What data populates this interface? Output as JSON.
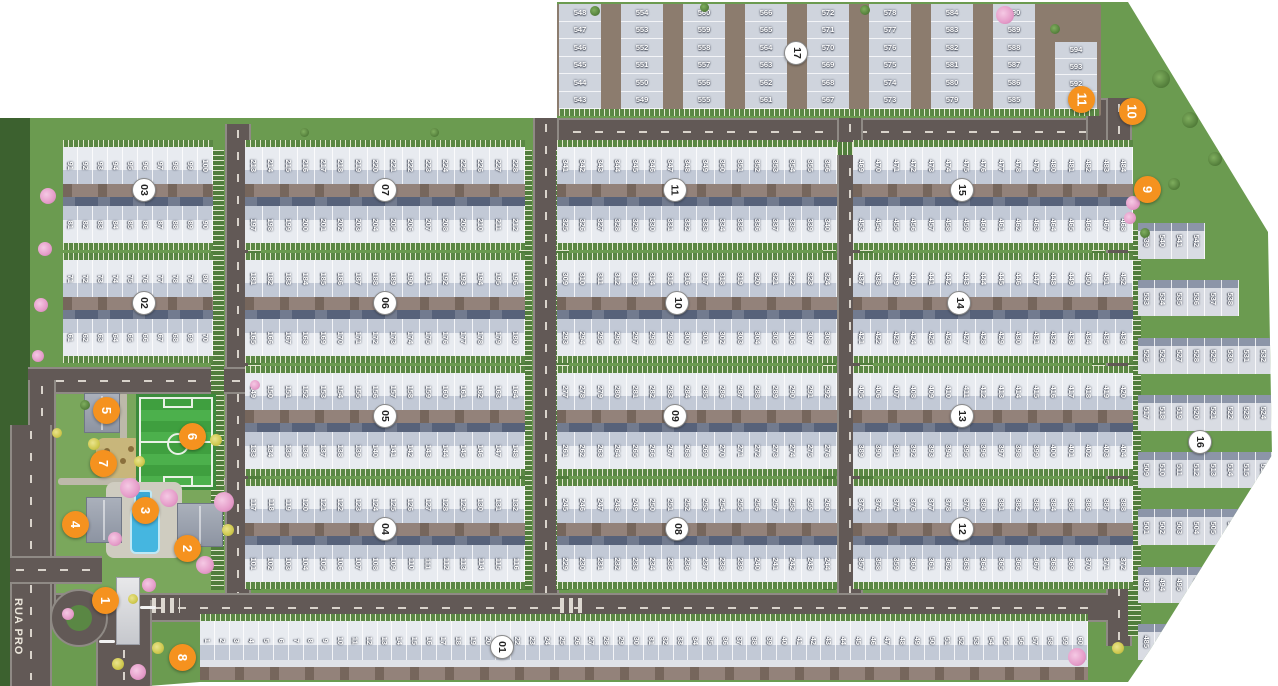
{
  "map_title": "residential lot masterplan",
  "street_label": "RUA PRO",
  "colors": {
    "background": "#ffffff",
    "grass": "#6b9b50",
    "grass_dark_edge": "#3c612f",
    "road": "#625956",
    "house_roof_light": "#cdd3dd",
    "house_roof_dark": "#57627a",
    "driveway_brown": "#93827a",
    "block_badge_bg": "#ffffff",
    "block_badge_text": "#222222",
    "amenity_badge_bg": "#f5921f",
    "amenity_badge_text": "#ffffff",
    "soccer_field": "#3f9f3f",
    "pool_water": "#45b6e0",
    "tree_pink": "#e59cc9",
    "tree_yellow": "#cfc84e"
  },
  "blocks": [
    {
      "label": "01",
      "type": "single-row",
      "rows": [
        {
          "from": 1,
          "to": 60
        }
      ]
    },
    {
      "label": "02",
      "type": "standard",
      "rows": [
        {
          "from": 71,
          "to": 80
        },
        {
          "from": 61,
          "to": 70
        }
      ]
    },
    {
      "label": "03",
      "type": "standard",
      "rows": [
        {
          "from": 91,
          "to": 100
        },
        {
          "from": 81,
          "to": 90
        }
      ]
    },
    {
      "label": "04",
      "type": "standard",
      "rows": [
        {
          "from": 117,
          "to": 132
        },
        {
          "from": 101,
          "to": 116
        }
      ]
    },
    {
      "label": "05",
      "type": "standard",
      "rows": [
        {
          "from": 149,
          "to": 164
        },
        {
          "from": 133,
          "to": 148
        }
      ]
    },
    {
      "label": "06",
      "type": "standard",
      "rows": [
        {
          "from": 181,
          "to": 196
        },
        {
          "from": 165,
          "to": 180
        }
      ]
    },
    {
      "label": "07",
      "type": "standard",
      "rows": [
        {
          "from": 213,
          "to": 228
        },
        {
          "from": 197,
          "to": 212
        }
      ]
    },
    {
      "label": "08",
      "type": "standard",
      "rows": [
        {
          "from": 245,
          "to": 260
        },
        {
          "from": 229,
          "to": 244
        }
      ]
    },
    {
      "label": "09",
      "type": "standard",
      "rows": [
        {
          "from": 277,
          "to": 292
        },
        {
          "from": 261,
          "to": 276
        }
      ]
    },
    {
      "label": "10",
      "type": "standard",
      "rows": [
        {
          "from": 309,
          "to": 324
        },
        {
          "from": 293,
          "to": 308
        }
      ]
    },
    {
      "label": "11",
      "type": "standard",
      "rows": [
        {
          "from": 341,
          "to": 356
        },
        {
          "from": 325,
          "to": 340
        }
      ]
    },
    {
      "label": "12",
      "type": "standard",
      "rows": [
        {
          "from": 373,
          "to": 388
        },
        {
          "from": 357,
          "to": 372
        }
      ]
    },
    {
      "label": "13",
      "type": "standard",
      "rows": [
        {
          "from": 405,
          "to": 420
        },
        {
          "from": 389,
          "to": 404
        }
      ]
    },
    {
      "label": "14",
      "type": "standard",
      "rows": [
        {
          "from": 437,
          "to": 452
        },
        {
          "from": 421,
          "to": 436
        }
      ]
    },
    {
      "label": "15",
      "type": "standard",
      "rows": [
        {
          "from": 469,
          "to": 484
        },
        {
          "from": 453,
          "to": 468
        }
      ]
    },
    {
      "label": "16",
      "type": "row-stack",
      "rows": [
        {
          "from": 539,
          "to": 542
        },
        {
          "from": 533,
          "to": 538
        },
        {
          "from": 525,
          "to": 532
        },
        {
          "from": 517,
          "to": 524
        },
        {
          "from": 509,
          "to": 516
        },
        {
          "from": 501,
          "to": 508
        },
        {
          "from": 493,
          "to": 500
        },
        {
          "from": 485,
          "to": 492
        }
      ]
    },
    {
      "label": "17",
      "type": "column-stack",
      "columns": [
        {
          "from": 543,
          "to": 548
        },
        {
          "from": 549,
          "to": 554
        },
        {
          "from": 555,
          "to": 560
        },
        {
          "from": 561,
          "to": 566
        },
        {
          "from": 567,
          "to": 572
        },
        {
          "from": 573,
          "to": 578
        },
        {
          "from": 579,
          "to": 584
        },
        {
          "from": 585,
          "to": 590
        },
        {
          "from": 591,
          "to": 594
        }
      ]
    }
  ],
  "amenity_badges": [
    "1",
    "2",
    "3",
    "4",
    "5",
    "6",
    "7",
    "8",
    "9",
    "10",
    "11"
  ]
}
